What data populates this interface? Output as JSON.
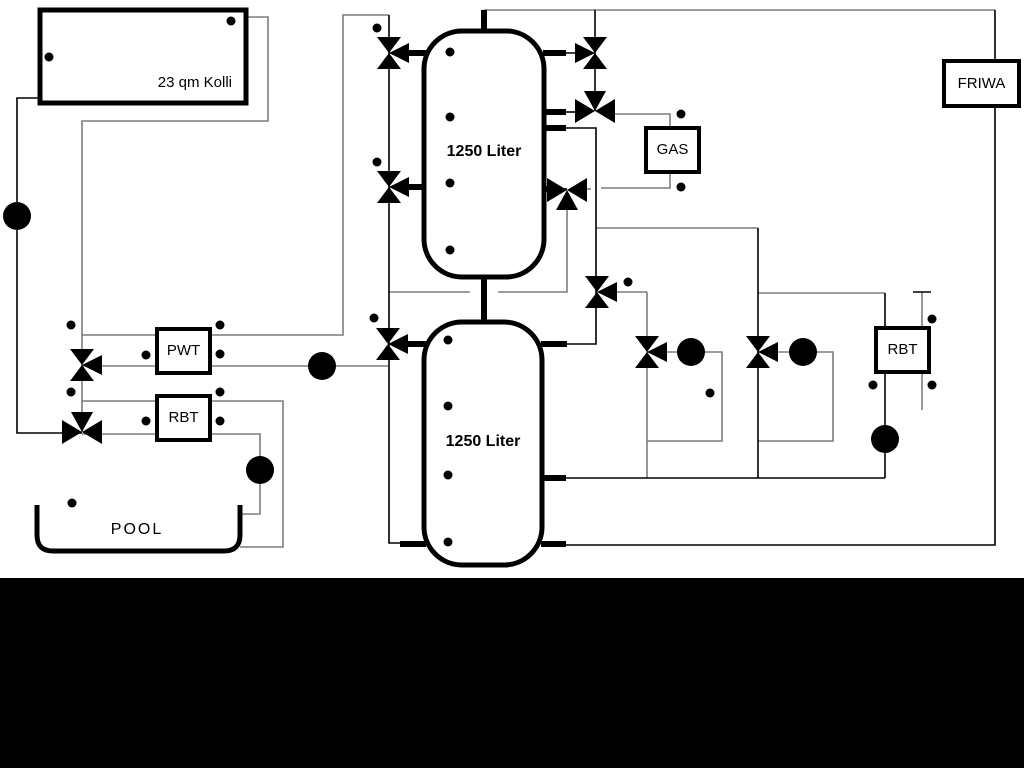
{
  "labels": {
    "collector": "23 qm Kolli",
    "tank_top": "1250 Liter",
    "tank_bottom": "1250 Liter",
    "pwt": "PWT",
    "rbt_left": "RBT",
    "gas": "GAS",
    "rbt_right": "RBT",
    "friwa": "FRIWA",
    "pool": "POOL"
  },
  "colors": {
    "pipe_gray": "#7d7d7d",
    "pipe_black": "#000000",
    "component_stroke": "#000000",
    "background": "#ffffff",
    "footer_bar": "#000000"
  }
}
